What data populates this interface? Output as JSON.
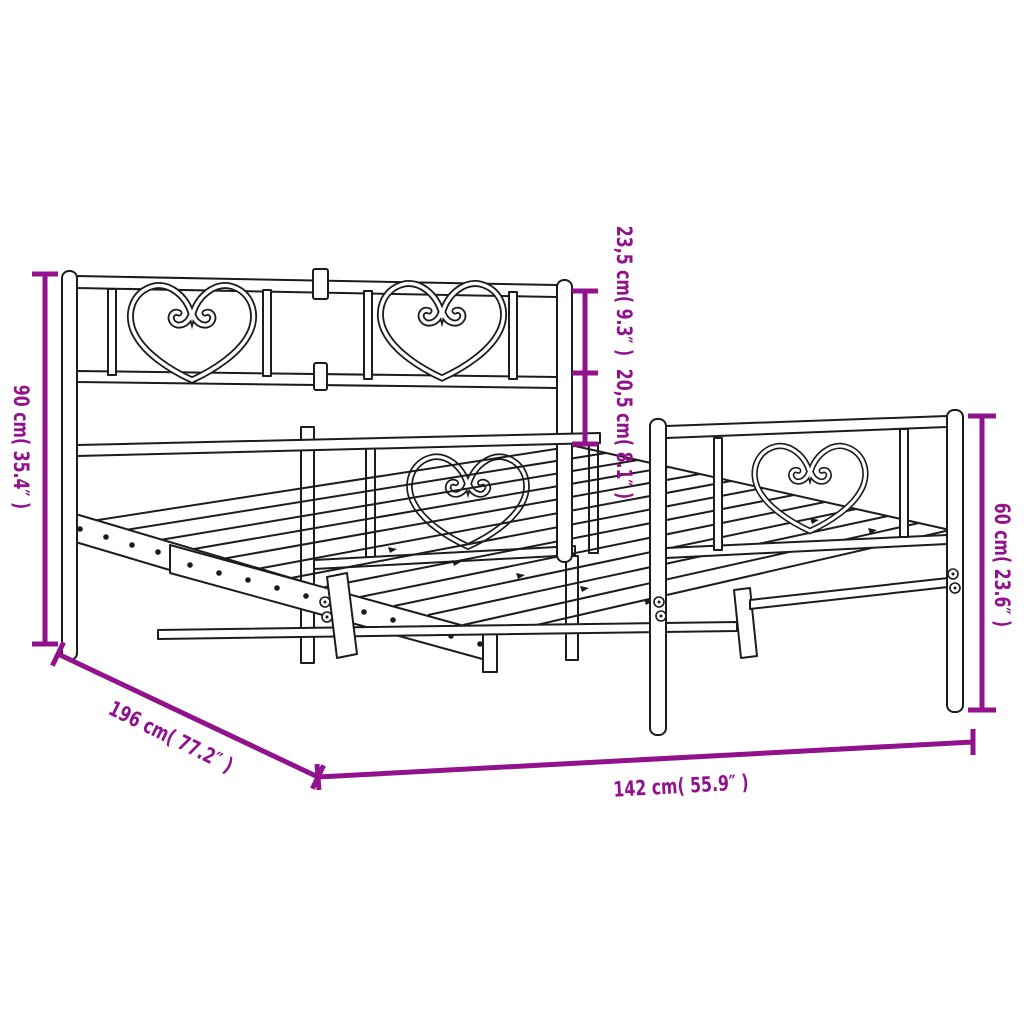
{
  "diagram": {
    "type": "product-dimension-diagram",
    "subject": "Metal bed frame with heart-design headboard and footboard",
    "accent_color": "#91128C",
    "ink_color": "#1c1c1c",
    "background_color": "#ffffff",
    "decorative_motif": "heart-scroll",
    "dimensions": [
      {
        "name": "headboard-height",
        "label": "90 cm( 35.4″ )",
        "cm": 90,
        "inches": 35.4,
        "placement": "left-vertical"
      },
      {
        "name": "headboard-upper-section",
        "label": "23,5 cm( 9.3″ )",
        "cm": 23.5,
        "inches": 9.3,
        "placement": "middle-vertical-upper"
      },
      {
        "name": "headboard-lower-section",
        "label": "20,5 cm( 8.1″ )",
        "cm": 20.5,
        "inches": 8.1,
        "placement": "middle-vertical-lower"
      },
      {
        "name": "footboard-height",
        "label": "60 cm( 23.6″ )",
        "cm": 60,
        "inches": 23.6,
        "placement": "right-vertical"
      },
      {
        "name": "frame-length",
        "label": "196 cm( 77.2″ )",
        "cm": 196,
        "inches": 77.2,
        "placement": "bottom-diagonal"
      },
      {
        "name": "frame-width",
        "label": "142 cm( 55.9″ )",
        "cm": 142,
        "inches": 55.9,
        "placement": "bottom-horizontal"
      }
    ]
  }
}
